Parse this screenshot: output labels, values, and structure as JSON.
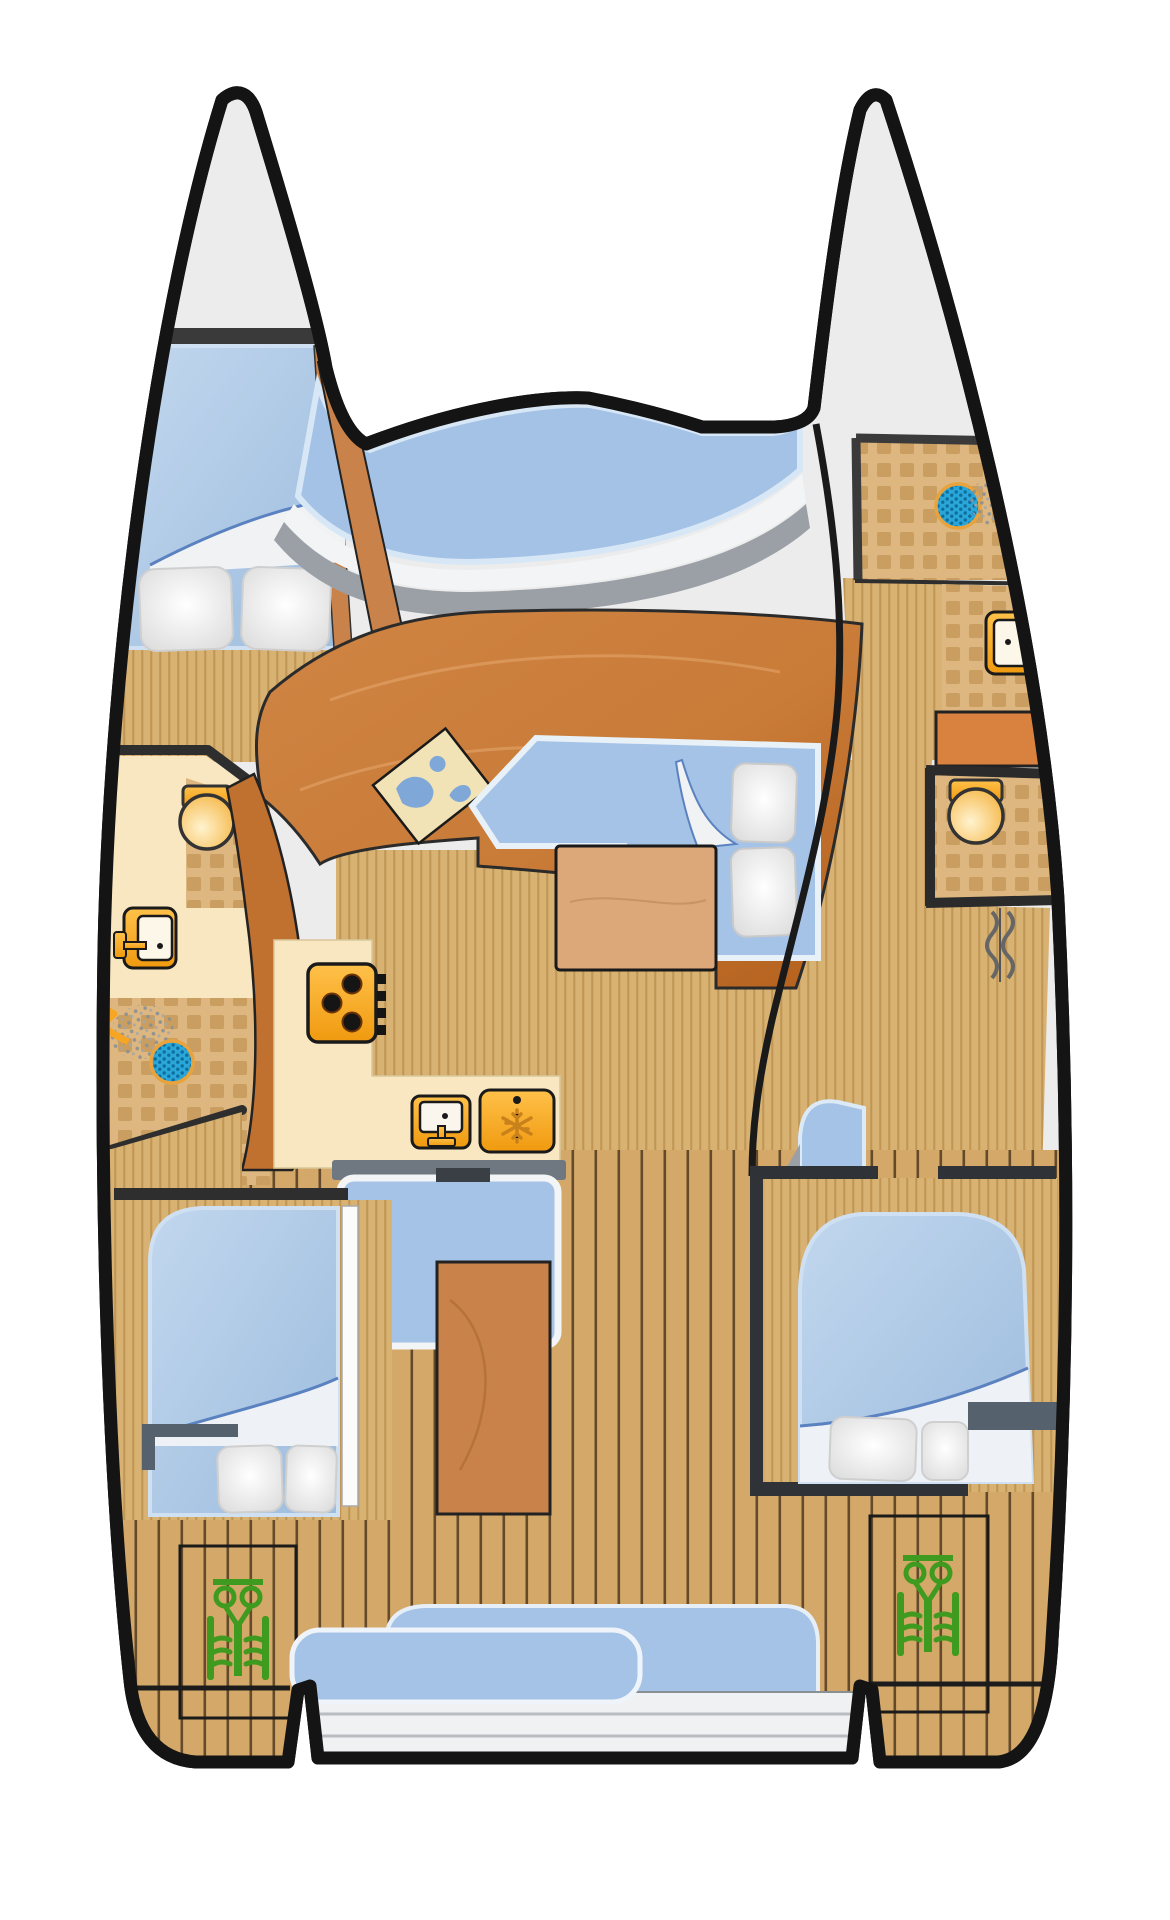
{
  "diagram": {
    "type": "catamaran-deck-floor-plan",
    "colors": {
      "outline": "#141414",
      "hull_fill": "#ececec",
      "water_blue": "#a5c3e6",
      "window_blue": "#a3c2e6",
      "window_edge": "#ddeaf8",
      "wood_floor": "#d8b272",
      "teak_deck": "#d4a868",
      "saloon_wood": "#c87a3d",
      "saloon_wood_dark": "#b05e1e",
      "divider_wood": "#c0702f",
      "accent_wood": "#c8824a",
      "table_wood": "#dca87a",
      "cockpit_table_wood": "#c8824a",
      "cream": "#f8e7c1",
      "tile_dark": "#c79a5c",
      "fixture_orange": "#f6a623",
      "step_orange": "#d9813e",
      "drain_blue": "#2aa7d8",
      "drain_rim": "#e8a33d",
      "engine_green": "#3f9b1f",
      "wall_dark": "#2e2e2e",
      "wall_slate": "#56616e",
      "band_gray": "#9aa0a6",
      "windshield_white": "#f2f4f5",
      "platform_gray": "#f0f1f2",
      "pillow_white": "#f4f4f4",
      "door_panel_white": "#fbfbfb"
    },
    "port_hull": {
      "fixtures": [
        "forward-double-berth",
        "pillows",
        "wc-toilet",
        "washbasin",
        "shower-drain",
        "shower-head",
        "aft-double-berth",
        "engine-hatch",
        "engine"
      ]
    },
    "starboard_hull": {
      "fixtures": [
        "shower-drain",
        "shower-head",
        "washbasin",
        "landing-step",
        "wc-toilet",
        "shower-curtain",
        "aft-double-berth",
        "engine-hatch",
        "engine"
      ]
    },
    "saloon": {
      "fixtures": [
        "foredeck-window",
        "windshield",
        "wraparound-settee",
        "chart-map",
        "convertible-berth",
        "pillows",
        "dining-table",
        "galley-counter",
        "stove",
        "galley-sink",
        "refrigerator",
        "companionway-steps"
      ]
    },
    "cockpit": {
      "fixtures": [
        "teak-deck",
        "cockpit-table",
        "aft-bench",
        "transom-platform",
        "transom-steps"
      ]
    }
  }
}
